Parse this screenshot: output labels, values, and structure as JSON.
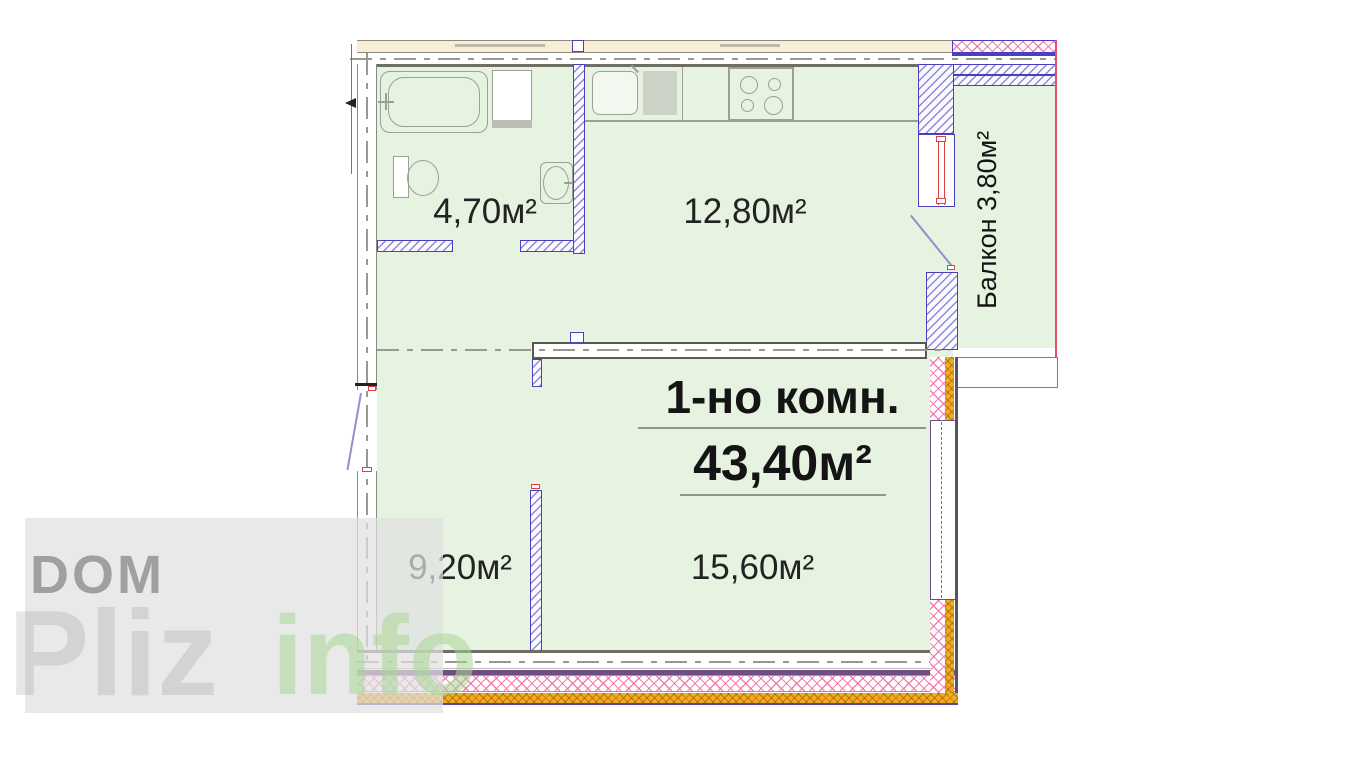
{
  "watermark": {
    "brand_top": "DOM",
    "brand_main": "Pliz",
    "brand_suffix": "info"
  },
  "plan": {
    "type_label": "1-но комн.",
    "total_area_label": "43,40м²",
    "rooms": {
      "bathroom_area": "4,70м²",
      "kitchen_area": "12,80м²",
      "hall_area": "9,20м²",
      "living_area": "15,60м²",
      "balcony_label": "Балкон 3,80м²"
    }
  },
  "colors": {
    "floor_fill": "#e5f3e0",
    "outer_band_beige": "#f8eed6",
    "partition_blue": "#4b3fc0",
    "hatch_pink": "#ef6ba8",
    "frame_red": "#e04040",
    "insulation_orange": "#f6a91e",
    "band_purple": "#6f4e84",
    "wall_gray": "#6e6e66"
  }
}
